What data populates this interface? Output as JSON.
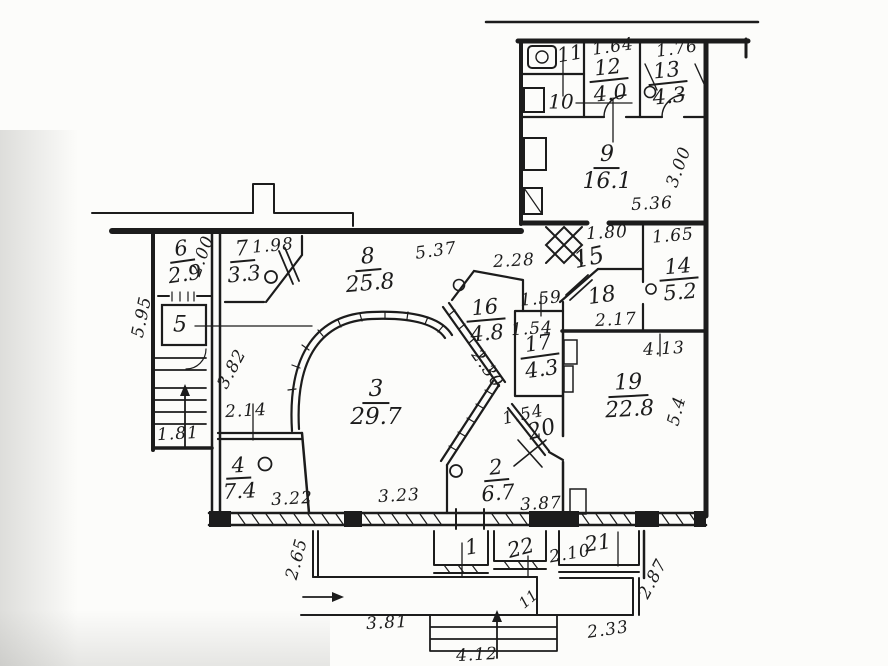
{
  "colors": {
    "ink": "#1c1c1c",
    "paper": "#fcfcfa"
  },
  "rooms": [
    {
      "num": "11",
      "x": 570,
      "y": 54,
      "rot": -10,
      "size": 20
    },
    {
      "num": "10",
      "x": 561,
      "y": 102,
      "rot": 0,
      "size": 20
    },
    {
      "num": "12",
      "area": "4.0",
      "x": 609,
      "y": 81,
      "rot": -6,
      "size": 21
    },
    {
      "num": "13",
      "area": "4.3",
      "x": 668,
      "y": 84,
      "rot": -6,
      "size": 21
    },
    {
      "num": "9",
      "area": "16.1",
      "x": 607,
      "y": 169,
      "rot": 0,
      "size": 22
    },
    {
      "num": "15",
      "x": 589,
      "y": 258,
      "rot": -12,
      "size": 24
    },
    {
      "num": "14",
      "area": "5.2",
      "x": 679,
      "y": 280,
      "rot": -5,
      "size": 21
    },
    {
      "num": "18",
      "x": 602,
      "y": 297,
      "rot": -8,
      "size": 22
    },
    {
      "num": "16",
      "area": "4.8",
      "x": 486,
      "y": 321,
      "rot": -5,
      "size": 21
    },
    {
      "num": "17",
      "area": "4.3",
      "x": 540,
      "y": 357,
      "rot": -8,
      "size": 21
    },
    {
      "num": "8",
      "area": "25.8",
      "x": 369,
      "y": 271,
      "rot": -5,
      "size": 22
    },
    {
      "num": "7",
      "area": "3.3",
      "x": 243,
      "y": 262,
      "rot": -5,
      "size": 21
    },
    {
      "num": "6",
      "area": "2.9",
      "x": 183,
      "y": 262,
      "rot": -8,
      "size": 21
    },
    {
      "num": "5",
      "x": 180,
      "y": 326,
      "rot": 0,
      "size": 22
    },
    {
      "num": "3",
      "area": "29.7",
      "x": 376,
      "y": 404,
      "rot": 0,
      "size": 23
    },
    {
      "num": "4",
      "area": "7.4",
      "x": 239,
      "y": 479,
      "rot": -3,
      "size": 21
    },
    {
      "num": "2",
      "area": "6.7",
      "x": 497,
      "y": 481,
      "rot": -5,
      "size": 21
    },
    {
      "num": "19",
      "area": "22.8",
      "x": 629,
      "y": 397,
      "rot": -3,
      "size": 22
    },
    {
      "num": "20",
      "x": 542,
      "y": 431,
      "rot": -15,
      "size": 22
    },
    {
      "num": "1",
      "x": 472,
      "y": 548,
      "rot": -10,
      "size": 21
    },
    {
      "num": "22",
      "x": 521,
      "y": 549,
      "rot": -15,
      "size": 21
    },
    {
      "num": "21",
      "x": 598,
      "y": 544,
      "rot": -8,
      "size": 21
    },
    {
      "num": "11",
      "x": 529,
      "y": 600,
      "rot": -40,
      "size": 15
    }
  ],
  "dims": [
    {
      "text": "1.64",
      "x": 613,
      "y": 47,
      "rot": -8
    },
    {
      "text": "1.76",
      "x": 677,
      "y": 49,
      "rot": -8
    },
    {
      "text": "3.00",
      "x": 679,
      "y": 167,
      "rot": -70
    },
    {
      "text": "5.36",
      "x": 652,
      "y": 204,
      "rot": -3
    },
    {
      "text": "1.80",
      "x": 607,
      "y": 233,
      "rot": -3
    },
    {
      "text": "1.65",
      "x": 673,
      "y": 236,
      "rot": -5
    },
    {
      "text": "5.37",
      "x": 436,
      "y": 251,
      "rot": -8
    },
    {
      "text": "2.28",
      "x": 514,
      "y": 261,
      "rot": -3
    },
    {
      "text": "1.98",
      "x": 273,
      "y": 246,
      "rot": -5
    },
    {
      "text": "2.00",
      "x": 202,
      "y": 256,
      "rot": -70
    },
    {
      "text": "1.59",
      "x": 541,
      "y": 299,
      "rot": -5
    },
    {
      "text": "1.54",
      "x": 532,
      "y": 329,
      "rot": -3
    },
    {
      "text": "2.17",
      "x": 616,
      "y": 320,
      "rot": -3
    },
    {
      "text": "4.13",
      "x": 664,
      "y": 349,
      "rot": -3
    },
    {
      "text": "5.4",
      "x": 677,
      "y": 411,
      "rot": -75
    },
    {
      "text": "2.30",
      "x": 487,
      "y": 369,
      "rot": 55
    },
    {
      "text": "2.14",
      "x": 246,
      "y": 411,
      "rot": -3
    },
    {
      "text": "3.82",
      "x": 232,
      "y": 369,
      "rot": -62
    },
    {
      "text": "5.95",
      "x": 142,
      "y": 317,
      "rot": -78
    },
    {
      "text": "1.81",
      "x": 178,
      "y": 434,
      "rot": -3
    },
    {
      "text": "3.22",
      "x": 292,
      "y": 499,
      "rot": -3
    },
    {
      "text": "3.23",
      "x": 399,
      "y": 496,
      "rot": -3
    },
    {
      "text": "1.54",
      "x": 523,
      "y": 415,
      "rot": -12
    },
    {
      "text": "3.87",
      "x": 541,
      "y": 504,
      "rot": -3
    },
    {
      "text": "2.65",
      "x": 297,
      "y": 559,
      "rot": -75
    },
    {
      "text": "3.81",
      "x": 387,
      "y": 623,
      "rot": -3
    },
    {
      "text": "4.12",
      "x": 477,
      "y": 655,
      "rot": -3
    },
    {
      "text": "2.10",
      "x": 570,
      "y": 554,
      "rot": -10
    },
    {
      "text": "2.33",
      "x": 608,
      "y": 630,
      "rot": -8
    },
    {
      "text": "2.87",
      "x": 653,
      "y": 579,
      "rot": -62
    }
  ]
}
